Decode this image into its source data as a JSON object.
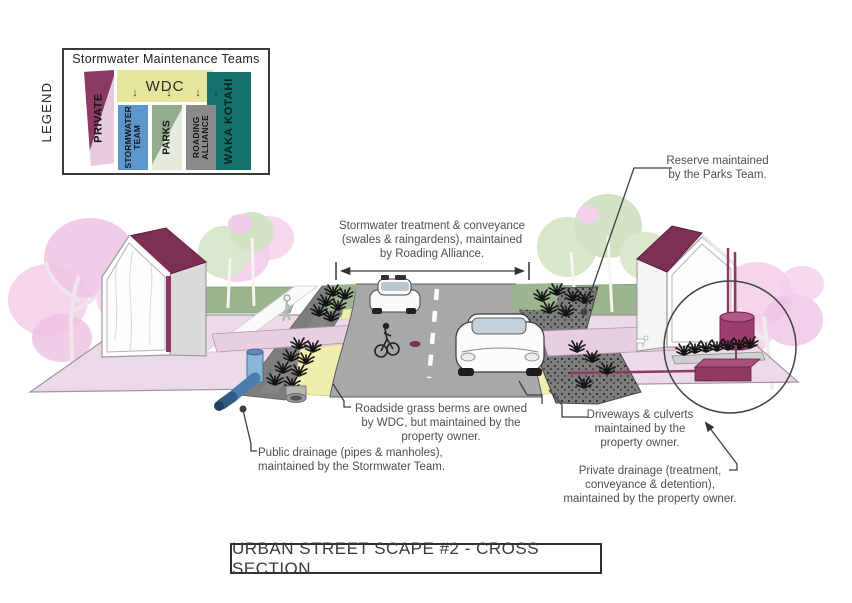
{
  "legend": {
    "side_label": "LEGEND",
    "title": "Stormwater Maintenance Teams",
    "arrow_glyph": "↓",
    "columns": {
      "private": {
        "label": "PRIVATE",
        "color_dark": "#8c3a64",
        "color_light": "#e5cbdb"
      },
      "wdc": {
        "label": "WDC",
        "color": "#e5e69c"
      },
      "stormwater": {
        "lines": [
          "STORMWATER",
          "TEAM"
        ],
        "color": "#5b97cc"
      },
      "parks": {
        "label": "PARKS",
        "color_dark": "#93ac8d",
        "color_light": "#e3ecdc"
      },
      "roading": {
        "lines": [
          "ROADING",
          "ALLIANCE"
        ],
        "color": "#8a8a8a"
      },
      "waka": {
        "label": "WAKA KOTAHI",
        "color": "#14716c"
      }
    }
  },
  "annotations": {
    "stormwater_treatment": {
      "lines": [
        "Stormwater treatment & conveyance",
        "(swales & raingardens), maintained",
        "by Roading Alliance."
      ]
    },
    "reserve": {
      "lines": [
        "Reserve maintained",
        "by the Parks Team."
      ]
    },
    "berms": {
      "lines": [
        "Roadside grass berms are owned",
        "by WDC, but maintained by the",
        "property owner."
      ]
    },
    "public_drainage": {
      "lines": [
        "Public drainage (pipes & manholes),",
        "maintained by the Stormwater Team."
      ]
    },
    "driveways": {
      "lines": [
        "Driveways & culverts",
        "maintained by the",
        "property owner."
      ]
    },
    "private_drainage": {
      "lines": [
        "Private drainage (treatment,",
        "conveyance & detention),",
        "maintained by the property owner."
      ]
    }
  },
  "footer": {
    "title": "URBAN STREET SCAPE #2 - CROSS SECTION"
  },
  "scene": {
    "colors": {
      "ground": "#ebdae7",
      "road": "#a8a8a8",
      "roof_maroon": "#7e2f55",
      "tank_maroon": "#9c3f6e",
      "detention_maroon": "#8e3a62",
      "berm_yellow": "#f0eeac",
      "lawn_green": "#9db58e",
      "swale_gray": "#7d7d7d",
      "pipe_blue": "#4a7cae",
      "driveway_pink": "#e7cfe1",
      "tree_pink": "#f3d0ea",
      "tree_green": "#d8e6ca",
      "leader": "#3f3f3f"
    }
  }
}
